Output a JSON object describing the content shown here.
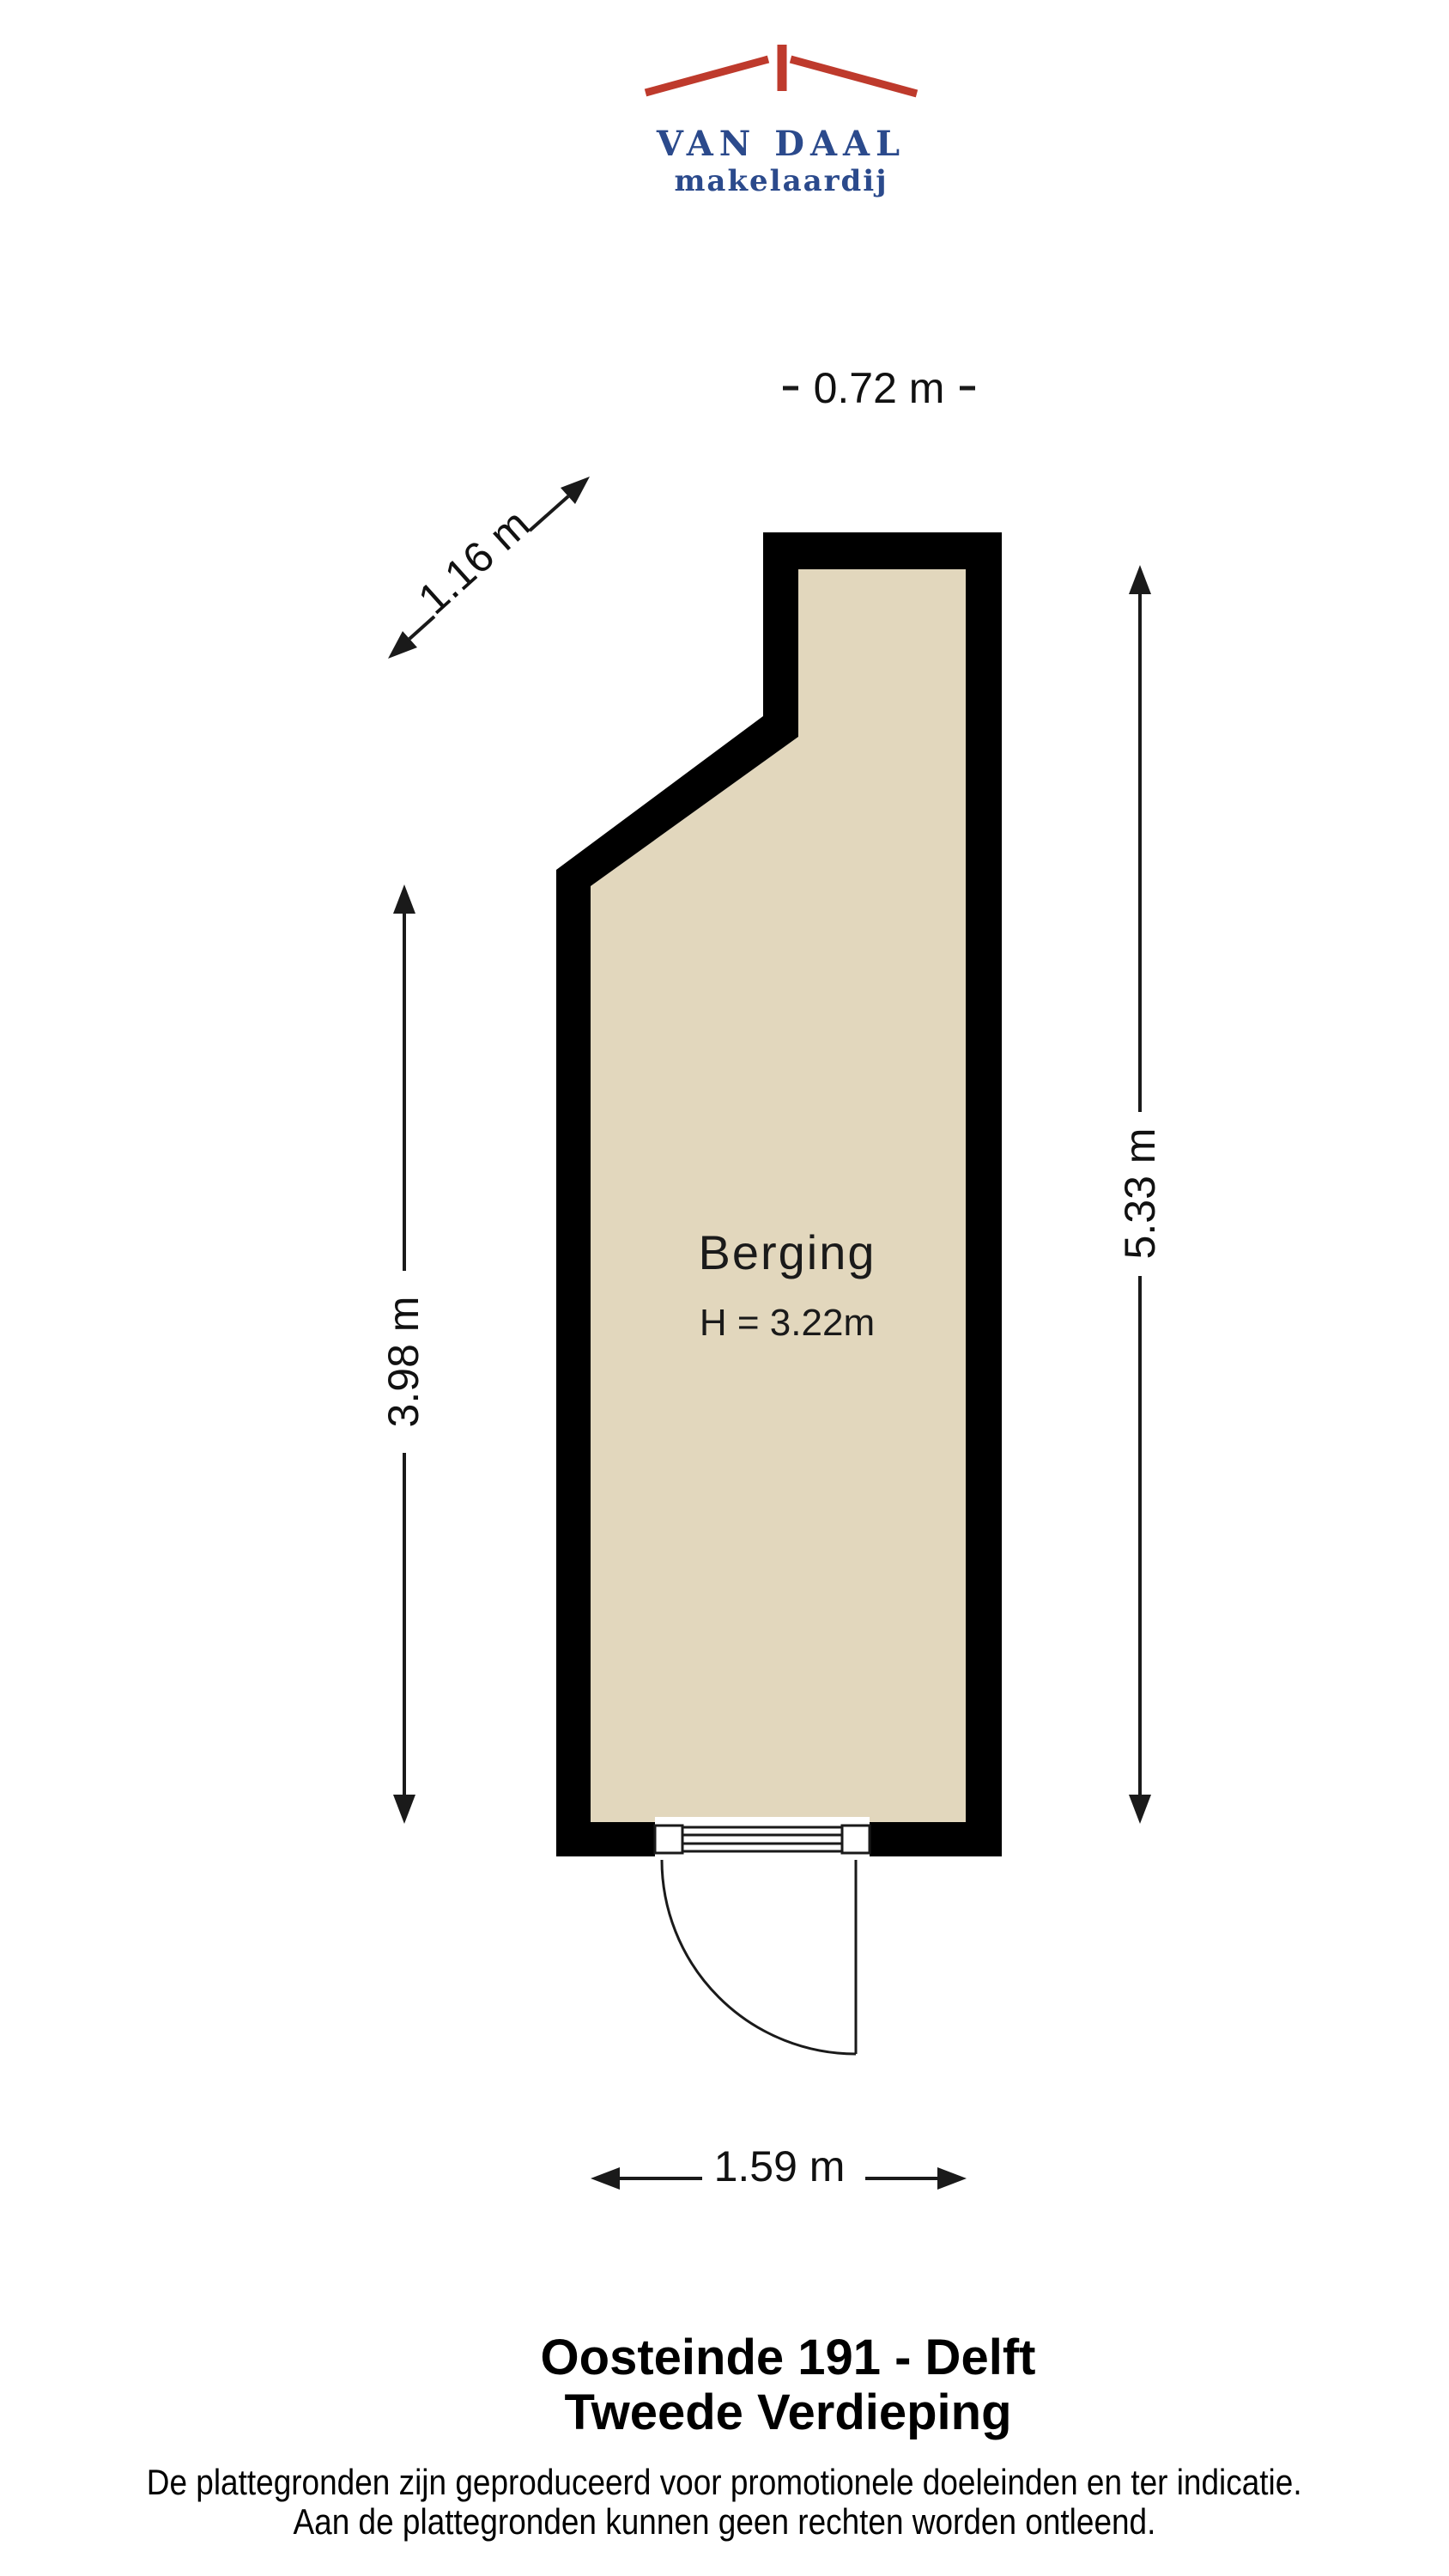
{
  "logo": {
    "line1": "VAN DAAL",
    "line2": "makelaardij",
    "brand_blue": "#2B4A8C",
    "brand_red": "#BE3A2C"
  },
  "plan": {
    "room": {
      "name": "Berging",
      "height_label": "H = 3.22m"
    },
    "dimensions": {
      "top": "0.72 m",
      "diagonal": "1.16 m",
      "left": "3.98 m",
      "right": "5.33 m",
      "bottom": "1.59 m"
    },
    "colors": {
      "wall": "#000000",
      "floor": "#E2D7BD",
      "dimension_line": "#1a1a1a"
    }
  },
  "footer": {
    "title": "Oosteinde 191 - Delft",
    "subtitle": "Tweede Verdieping",
    "disclaimer_line1": "De plattegronden zijn geproduceerd voor promotionele doeleinden en ter indicatie.",
    "disclaimer_line2": "Aan de plattegronden kunnen geen rechten worden ontleend."
  }
}
